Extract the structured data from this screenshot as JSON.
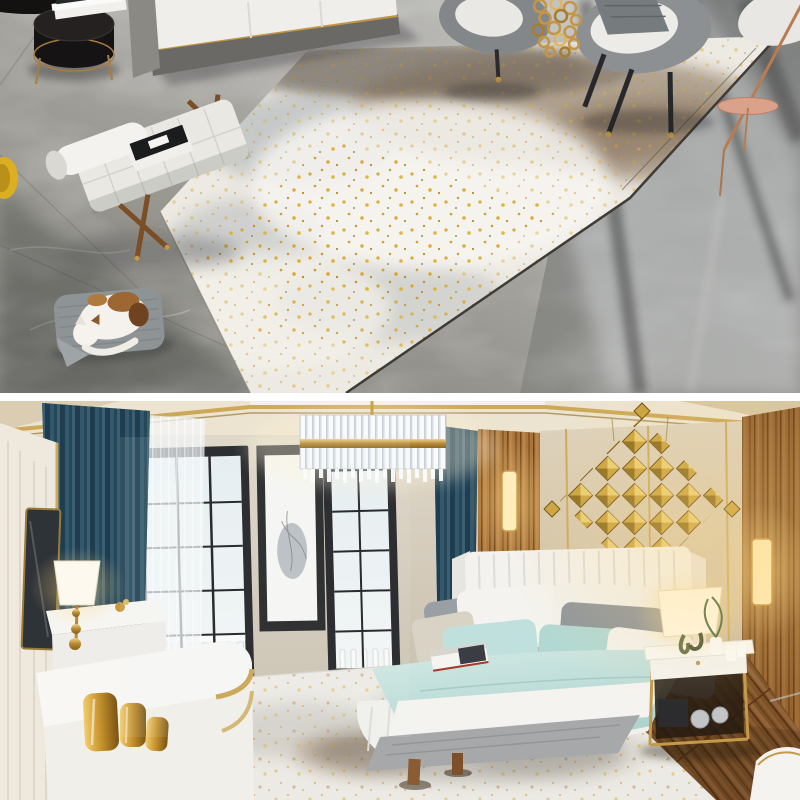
{
  "page": {
    "type": "rug product photo collage",
    "frames": 2,
    "width": 800,
    "height": 800
  },
  "divider": {
    "color": "#ffffff"
  },
  "scene_top": {
    "name": "living room photo",
    "description": "overhead angled view of a modern living room: large abstract distressed rug in ivory, grey-blue and taupe with scattered gold speckles lying on a polished grey marble floor",
    "objects": [
      "grey sofa with white cushions and gold piping",
      "black drum side table with gold trim and stacked books",
      "white tufted daybed bench with wooden cross legs and books",
      "sleeping white-and-brown cat on grey pet cushion",
      "two grey barrel armchairs with throw blanket",
      "hanging gold ring-chain decor",
      "copper floor lamp pole with pink disc side table",
      "yellow stool at left edge",
      "abstract area rug with dark edge band"
    ],
    "palette": {
      "marble_grey": "#a3a2a0",
      "marble_dark": "#77767a",
      "rug_ivory": "#edeae3",
      "rug_taupe": "#96836d",
      "rug_grey_blue": "#9fa8ad",
      "rug_gold": "#d9a62c",
      "sofa_white": "#efeeea",
      "sofa_grey": "#6b6965",
      "gold_trim": "#c09544",
      "copper": "#b97c52",
      "cat_brown": "#9c6733",
      "pet_bed_grey": "#8e9396"
    }
  },
  "scene_bottom": {
    "name": "bedroom photo",
    "description": "modern luxury bedroom: white channel-tufted bed with aqua and grey bedding on an ivory gold-speckled rug over herringbone wood floor, teal curtains, black framed windows, crystal chandelier and gold 3D diamond wall sculpture",
    "objects": [
      "teal blue drapes",
      "white sheer curtains",
      "black framed windows with white balustrade outside",
      "vertical black-framed ink artwork",
      "crystal chandelier with gold band",
      "gold 3D diamond wall sculpture on beige upholstered panels",
      "wood slat walls with vertical sconce lights",
      "white channel-tufted bed with wing headboard",
      "aqua, grey and white pillows",
      "aqua duvet with white fringed runner and grey throw",
      "magazine on bed",
      "white nightstand with gold frame, lamp, plant and glass jars",
      "white dresser with lit table lamp",
      "white console with gold vases and gold band",
      "cream wardrobe with leaning mirror",
      "herringbone wood floor",
      "ivory abstract rug with gold speckles",
      "white floor lamp in right corner"
    ],
    "palette": {
      "curtain_teal": "#2a4c60",
      "wall_greige": "#d3cbbd",
      "panel_beige": "#d6cbb6",
      "wood_warm": "#a8743c",
      "floor_wood": "#7c5128",
      "gold_trim": "#c9a24b",
      "gold_diamond": "#c9a23c",
      "bedding_aqua": "#b2d8d4",
      "bed_white": "#f3f2ee",
      "pillow_grey": "#8e959b",
      "rug_ivory": "#eceae4",
      "rug_gold": "#d9a62c",
      "lamp_glow": "#ffe9b4"
    }
  }
}
